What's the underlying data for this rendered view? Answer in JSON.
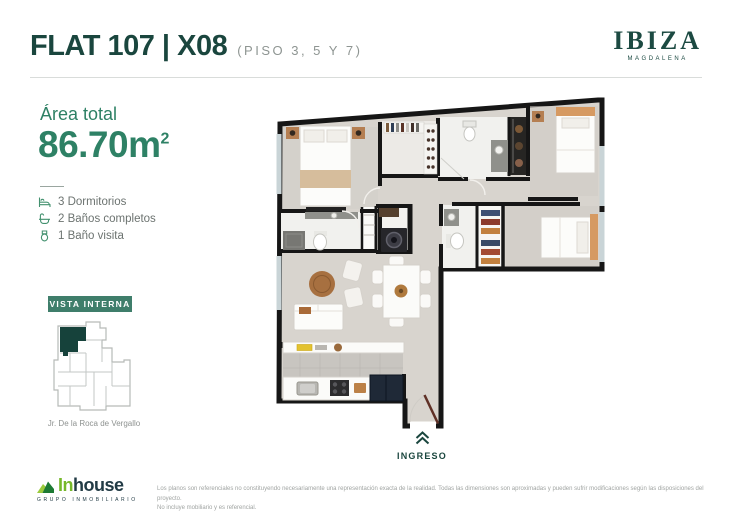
{
  "header": {
    "title": "FLAT 107 | X08",
    "subtitle": "(PISO 3, 5 Y 7)"
  },
  "brand": {
    "name": "IBIZA",
    "location": "MAGDALENA"
  },
  "area": {
    "label": "Área total",
    "value": "86.70m",
    "superscript": "2"
  },
  "features": [
    {
      "icon": "bed-icon",
      "label": "3 Dormitorios"
    },
    {
      "icon": "bath-icon",
      "label": "2 Baños completos"
    },
    {
      "icon": "toilet-icon",
      "label": "1 Baño visita"
    }
  ],
  "vista": {
    "badge": "VISTA INTERNA",
    "street": "Jr. De la Roca de Vergallo"
  },
  "entrance": {
    "label": "INGRESO",
    "icon": "chevrons-up-icon"
  },
  "footer": {
    "logo_part1": "In",
    "logo_part2": "house",
    "logo_tagline": "GRUPO INMOBILIARIO",
    "disclaimer_line1": "Los planos son referenciales no constituyendo necesariamente una representación exacta de la realidad. Todas las dimensiones son aproximadas y pueden sufrir modificaciones según las disposiciones del proyecto.",
    "disclaimer_line2": "No incluye mobiliario y es referencial."
  },
  "colors": {
    "title_green": "#1a463e",
    "accent_green": "#2e8165",
    "badge_green": "#3f7e6b",
    "logo_green": "#76b82a",
    "logo_dark": "#223b45",
    "minimap_highlight": "#16423b",
    "wall_black": "#161616",
    "floor_gray": "#d8d4ce"
  }
}
